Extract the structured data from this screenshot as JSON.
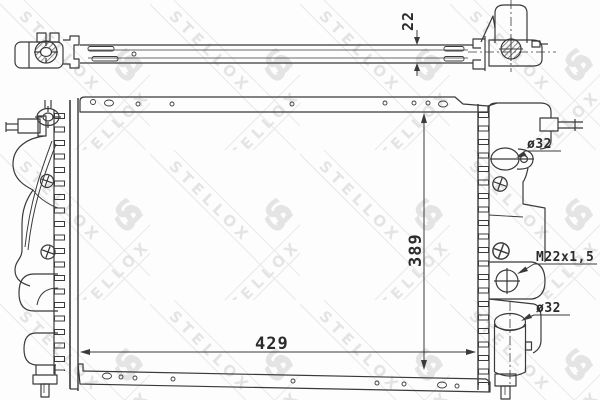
{
  "page": {
    "width": 600,
    "height": 400,
    "kind": "technical line drawing of automotive radiator, top view and front view"
  },
  "watermark": {
    "brand": "STELLOX",
    "letter": "S"
  },
  "labels": {
    "core_thickness": "22",
    "core_height": "389",
    "core_width": "429",
    "upper_port_diameter": "ø32",
    "drain_plug_thread": "M22x1,5",
    "lower_port_diameter": "ø32"
  },
  "colors": {
    "line": "#3a3a3a",
    "dimension_text": "#2b2b2b",
    "background": "#fdfdfd",
    "watermark": "#e4e4e4"
  }
}
